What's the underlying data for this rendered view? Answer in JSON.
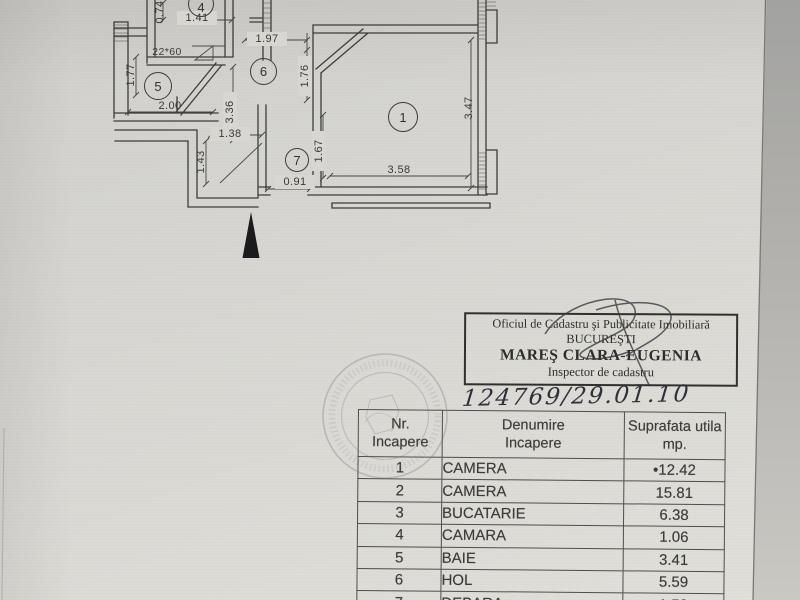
{
  "plan": {
    "room_numbers": {
      "r1": "1",
      "r4": "4",
      "r5": "5",
      "r6": "6",
      "r7": "7"
    },
    "dimensions": {
      "v074": "0.74",
      "h141": "1.41",
      "h197": "1.97",
      "v176": "1.76",
      "v347": "3.47",
      "h358": "3.58",
      "v177": "1.77",
      "h200": "2.00",
      "shaft": "22*60",
      "v336": "3.36",
      "h138": "1.38",
      "v143": "1.43",
      "v167": "1.67",
      "h091": "0.91"
    }
  },
  "stamp_box": {
    "office_line": "Oficiul de Cadastru şi Publicitate Imobiliară",
    "city": "BUCUREŞTI",
    "inspector_name": "MAREŞ CLARA-EUGENIA",
    "inspector_title": "Inspector de cadastru"
  },
  "handwriting": {
    "registration_number": "124769/29.01.10"
  },
  "table": {
    "headers": [
      {
        "line1": "Nr.",
        "line2": "Incapere"
      },
      {
        "line1": "Denumire",
        "line2": "Incapere"
      },
      {
        "line1": "Suprafata utila",
        "line2": "mp."
      }
    ],
    "rows": [
      {
        "nr": "1",
        "name": "CAMERA",
        "area": "•12.42"
      },
      {
        "nr": "2",
        "name": "CAMERA",
        "area": "15.81"
      },
      {
        "nr": "3",
        "name": "BUCATARIE",
        "area": "6.38"
      },
      {
        "nr": "4",
        "name": "CAMARA",
        "area": "1.06"
      },
      {
        "nr": "5",
        "name": "BAIE",
        "area": "3.41"
      },
      {
        "nr": "6",
        "name": "HOL",
        "area": "5.59"
      },
      {
        "nr": "7",
        "name": "DEBARA",
        "area": "1.52"
      }
    ]
  }
}
